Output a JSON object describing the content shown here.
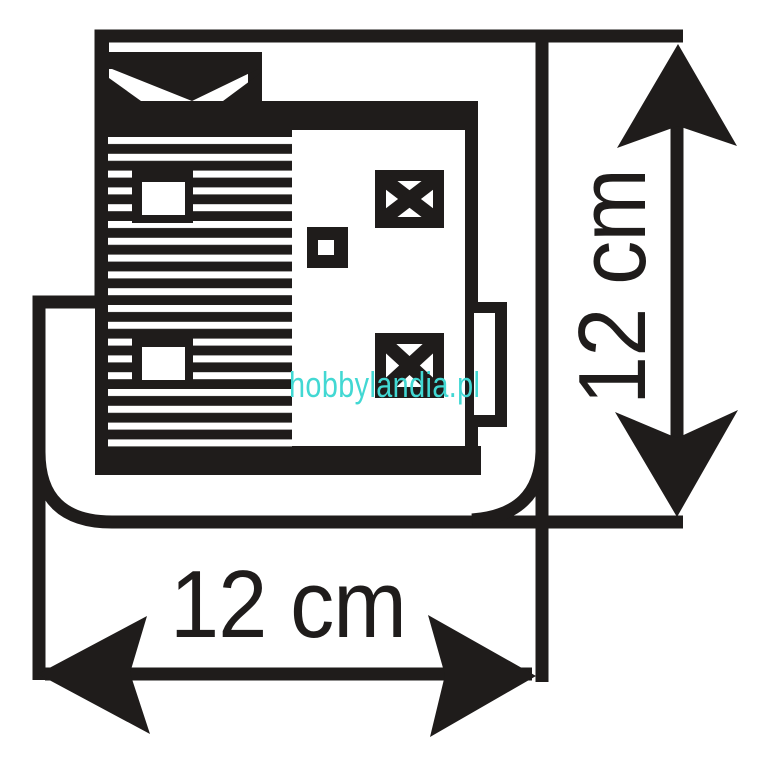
{
  "page": {
    "background_color": "#ffffff"
  },
  "diagram": {
    "kind": "technical-dimension-drawing",
    "subject": "top view of model building footprint on rounded base plate",
    "ink_color": "#1f1c1b",
    "dimensions": {
      "vertical": {
        "label": "12 cm"
      },
      "horizontal": {
        "label": "12 cm"
      }
    },
    "watermark": {
      "text": "hobbylandia.pl",
      "color": "#42d8d3"
    }
  }
}
